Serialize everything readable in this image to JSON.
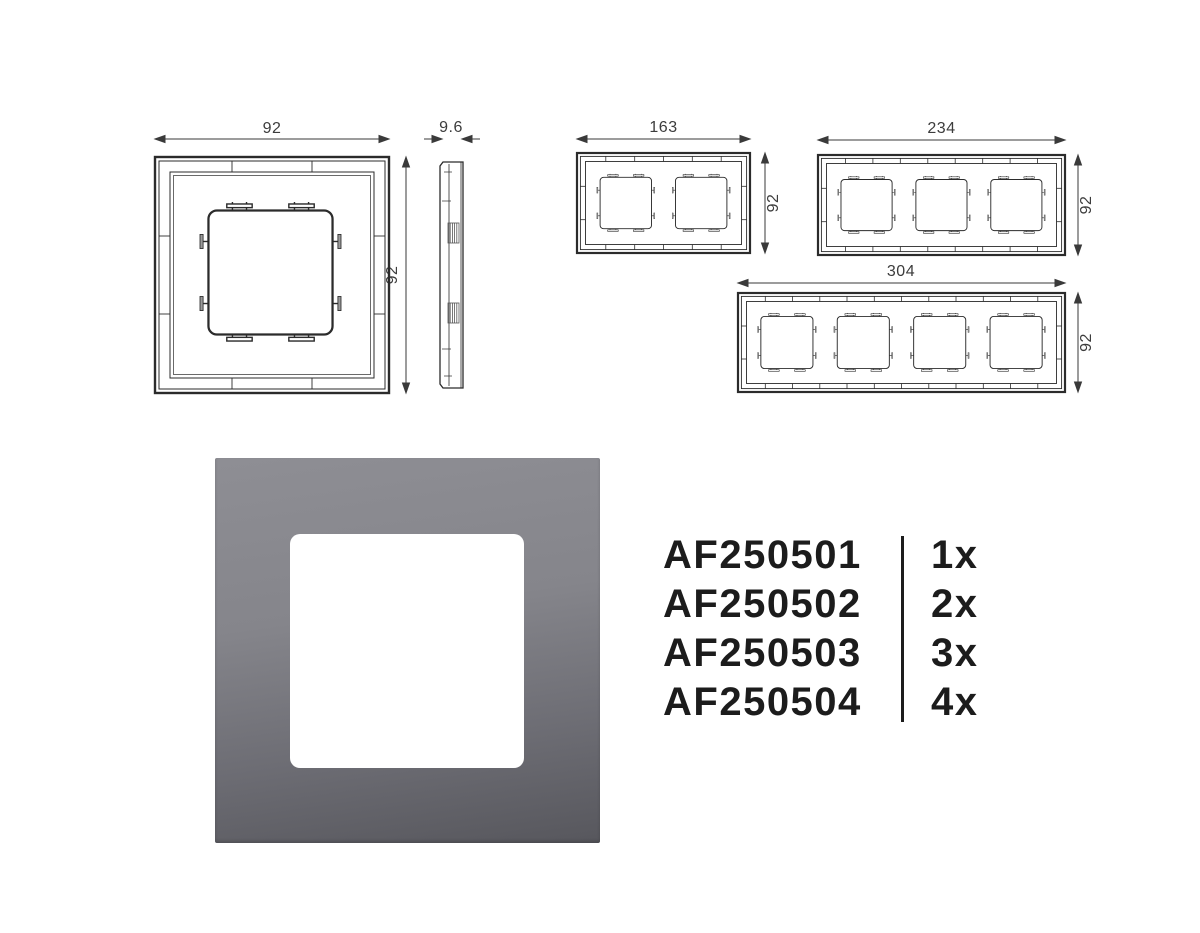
{
  "page": {
    "background": "#ffffff"
  },
  "drawings": {
    "one_gang_front": {
      "width_dim": "92",
      "height_dim": "92"
    },
    "side_profile": {
      "depth_dim": "9.6"
    },
    "two_gang_front": {
      "width_dim": "163",
      "height_dim": "92"
    },
    "three_gang_front": {
      "width_dim": "234",
      "height_dim": "92"
    },
    "four_gang_front": {
      "width_dim": "304",
      "height_dim": "92"
    }
  },
  "product_render": {
    "frame_color_top": "#8e8e94",
    "frame_color_bottom": "#57575d",
    "window_color": "#ffffff"
  },
  "product_list": {
    "text_color": "#1c1c1c",
    "items": [
      {
        "code": "AF250501",
        "qty": "1x"
      },
      {
        "code": "AF250502",
        "qty": "2x"
      },
      {
        "code": "AF250503",
        "qty": "3x"
      },
      {
        "code": "AF250504",
        "qty": "4x"
      }
    ]
  }
}
